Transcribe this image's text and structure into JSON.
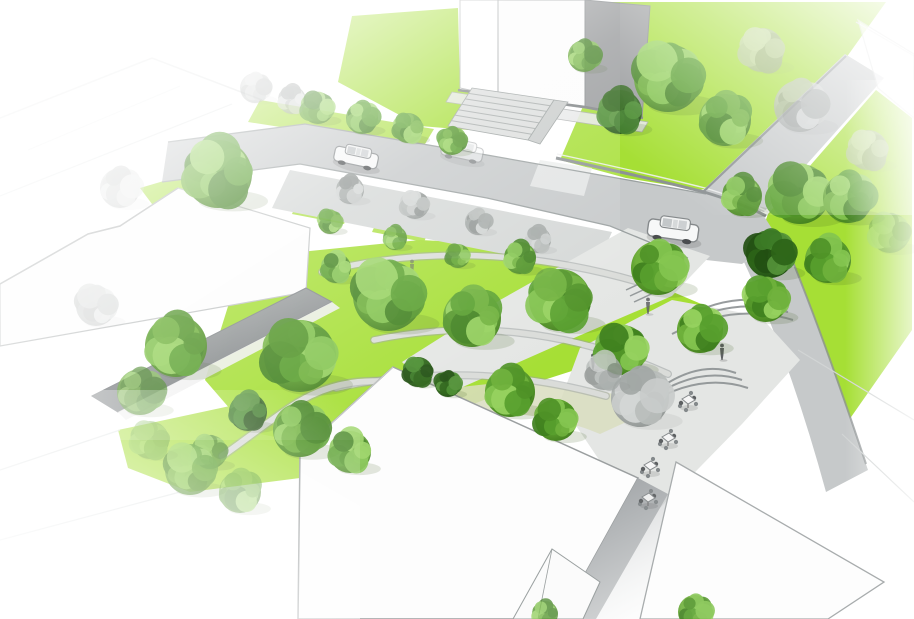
{
  "scene": {
    "alt": "Aerial architectural rendering of an urban street intersection redesigned as a tree-filled pocket park: bright green lawns, curved walkways, amphitheater steps, cafe seating, parked cars and white flat-roofed buildings fading to white at the edges"
  },
  "colors": {
    "lawn": "#a6df35",
    "lawnPale": "#c8eb86",
    "street": "#c6c9ca",
    "sidewalk": "#d5d8d7",
    "plaza": "#e4e6e4",
    "path": "#dadcd9",
    "pathOlive": "#d9ddc0",
    "kerb": "#9aa0a0",
    "wall": "#8d9294",
    "roofWhite": "#fdfdfd",
    "roofLine": "#a5a9aa",
    "bldgSide": "#97999b",
    "treeTrunk": "#6b5f52",
    "carBody": "#f7f8f8",
    "carLine": "#85898b",
    "figure": "#5d6062"
  },
  "trees": [
    {
      "x": 255,
      "y": 88,
      "r": 15,
      "t": "s",
      "o": 0.55
    },
    {
      "x": 292,
      "y": 100,
      "r": 14,
      "t": "s",
      "o": 0.7
    },
    {
      "x": 318,
      "y": 108,
      "r": 16,
      "t": "g",
      "o": 0.9
    },
    {
      "x": 362,
      "y": 118,
      "r": 16,
      "t": "g"
    },
    {
      "x": 408,
      "y": 128,
      "r": 15,
      "t": "g"
    },
    {
      "x": 452,
      "y": 141,
      "r": 14,
      "t": "g"
    },
    {
      "x": 350,
      "y": 190,
      "r": 14,
      "t": "s"
    },
    {
      "x": 415,
      "y": 205,
      "r": 14,
      "t": "s"
    },
    {
      "x": 478,
      "y": 222,
      "r": 13,
      "t": "s"
    },
    {
      "x": 538,
      "y": 240,
      "r": 13,
      "t": "s"
    },
    {
      "x": 330,
      "y": 222,
      "r": 12,
      "t": "g",
      "o": 0.9
    },
    {
      "x": 395,
      "y": 238,
      "r": 12,
      "t": "g",
      "o": 0.9
    },
    {
      "x": 458,
      "y": 256,
      "r": 12,
      "t": "g",
      "o": 0.9
    },
    {
      "x": 584,
      "y": 56,
      "r": 16,
      "t": "g",
      "o": 0.9
    },
    {
      "x": 620,
      "y": 112,
      "r": 22,
      "t": "d"
    },
    {
      "x": 668,
      "y": 78,
      "r": 34,
      "t": "g"
    },
    {
      "x": 725,
      "y": 120,
      "r": 26,
      "t": "g"
    },
    {
      "x": 762,
      "y": 50,
      "r": 22,
      "t": "s",
      "o": 0.6
    },
    {
      "x": 800,
      "y": 106,
      "r": 26,
      "t": "s",
      "o": 0.75
    },
    {
      "x": 742,
      "y": 196,
      "r": 20,
      "t": "g",
      "o": 0.95
    },
    {
      "x": 800,
      "y": 194,
      "r": 30,
      "t": "g"
    },
    {
      "x": 848,
      "y": 198,
      "r": 25,
      "t": "g"
    },
    {
      "x": 868,
      "y": 150,
      "r": 20,
      "t": "s",
      "o": 0.6
    },
    {
      "x": 770,
      "y": 254,
      "r": 24,
      "t": "d"
    },
    {
      "x": 828,
      "y": 260,
      "r": 23,
      "t": "g"
    },
    {
      "x": 890,
      "y": 233,
      "r": 20,
      "t": "g",
      "o": 0.55
    },
    {
      "x": 120,
      "y": 188,
      "r": 20,
      "t": "s",
      "o": 0.4
    },
    {
      "x": 218,
      "y": 174,
      "r": 34,
      "t": "g"
    },
    {
      "x": 96,
      "y": 306,
      "r": 20,
      "t": "s",
      "o": 0.35
    },
    {
      "x": 176,
      "y": 346,
      "r": 31,
      "t": "g"
    },
    {
      "x": 300,
      "y": 356,
      "r": 36,
      "t": "g"
    },
    {
      "x": 140,
      "y": 392,
      "r": 23,
      "t": "g",
      "o": 0.75
    },
    {
      "x": 336,
      "y": 268,
      "r": 15,
      "t": "g"
    },
    {
      "x": 388,
      "y": 296,
      "r": 35,
      "t": "g"
    },
    {
      "x": 472,
      "y": 318,
      "r": 29,
      "t": "g"
    },
    {
      "x": 560,
      "y": 300,
      "r": 31,
      "t": "g"
    },
    {
      "x": 658,
      "y": 268,
      "r": 27,
      "t": "g"
    },
    {
      "x": 520,
      "y": 258,
      "r": 16,
      "t": "g"
    },
    {
      "x": 622,
      "y": 350,
      "r": 25,
      "t": "g"
    },
    {
      "x": 700,
      "y": 330,
      "r": 23,
      "t": "g"
    },
    {
      "x": 418,
      "y": 372,
      "r": 15,
      "t": "d"
    },
    {
      "x": 448,
      "y": 384,
      "r": 13,
      "t": "d"
    },
    {
      "x": 248,
      "y": 412,
      "r": 19,
      "t": "d"
    },
    {
      "x": 210,
      "y": 452,
      "r": 17,
      "t": "g",
      "o": 0.85
    },
    {
      "x": 640,
      "y": 398,
      "r": 29,
      "t": "s"
    },
    {
      "x": 604,
      "y": 372,
      "r": 18,
      "t": "s",
      "o": 0.85
    },
    {
      "x": 766,
      "y": 300,
      "r": 22,
      "t": "g"
    },
    {
      "x": 510,
      "y": 392,
      "r": 25,
      "t": "g"
    },
    {
      "x": 556,
      "y": 420,
      "r": 21,
      "t": "g"
    },
    {
      "x": 300,
      "y": 430,
      "r": 27,
      "t": "g"
    },
    {
      "x": 350,
      "y": 452,
      "r": 21,
      "t": "g",
      "o": 0.9
    },
    {
      "x": 190,
      "y": 470,
      "r": 25,
      "t": "g",
      "o": 0.8
    },
    {
      "x": 240,
      "y": 492,
      "r": 21,
      "t": "g",
      "o": 0.6
    },
    {
      "x": 150,
      "y": 440,
      "r": 19,
      "t": "g",
      "o": 0.5
    },
    {
      "x": 695,
      "y": 612,
      "r": 17,
      "t": "g",
      "o": 0.9
    },
    {
      "x": 545,
      "y": 614,
      "r": 13,
      "t": "g",
      "o": 0.75
    }
  ],
  "cars": [
    {
      "x": 356,
      "y": 158,
      "a": 12,
      "s": 1.0,
      "o": 1
    },
    {
      "x": 462,
      "y": 152,
      "a": 12,
      "s": 0.95,
      "o": 0.5
    },
    {
      "x": 673,
      "y": 231,
      "a": 8,
      "s": 1.15,
      "o": 1
    }
  ],
  "tables": [
    {
      "x": 652,
      "y": 412
    },
    {
      "x": 688,
      "y": 402
    },
    {
      "x": 668,
      "y": 440
    },
    {
      "x": 650,
      "y": 468
    },
    {
      "x": 648,
      "y": 500,
      "o": 0.9
    }
  ],
  "people": [
    {
      "x": 722,
      "y": 352
    },
    {
      "x": 593,
      "y": 362
    },
    {
      "x": 648,
      "y": 306,
      "o": 0.85
    },
    {
      "x": 412,
      "y": 268,
      "o": 0.6
    }
  ]
}
